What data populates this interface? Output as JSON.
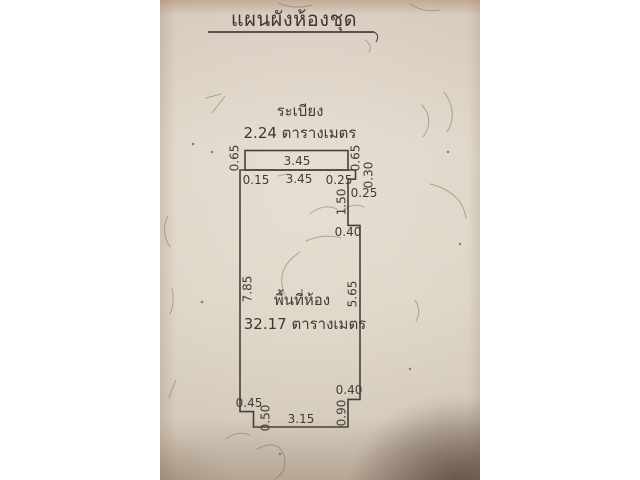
{
  "document": {
    "title": "แผนผังห้องชุด"
  },
  "balcony": {
    "label": "ระเบียง",
    "area": "2.24 ตารางเมตร",
    "dim_width": "3.45",
    "dim_height_left": "0.65",
    "dim_height_right": "0.65"
  },
  "room": {
    "label": "พื้นที่ห้อง",
    "area": "32.17 ตารางเมตร",
    "dim_top_left": "0.15",
    "dim_top_width": "3.45",
    "dim_top_right": "0.25",
    "dim_notch_down": "0.30",
    "dim_notch_in": "0.25",
    "dim_recess_height": "1.50",
    "dim_notch_out": "0.40",
    "dim_left_height": "7.85",
    "dim_right_height": "5.65",
    "dim_bottom_right_in": "0.40",
    "dim_bottom_right_height": "0.90",
    "dim_bottom_left_in": "0.45",
    "dim_bottom_left_height": "0.50",
    "dim_bottom_width": "3.15"
  },
  "colors": {
    "paper": "#d7cebf",
    "ink": "#46403a",
    "corner_shadow": "#5a4434",
    "canvas_background": "#ffffff"
  }
}
